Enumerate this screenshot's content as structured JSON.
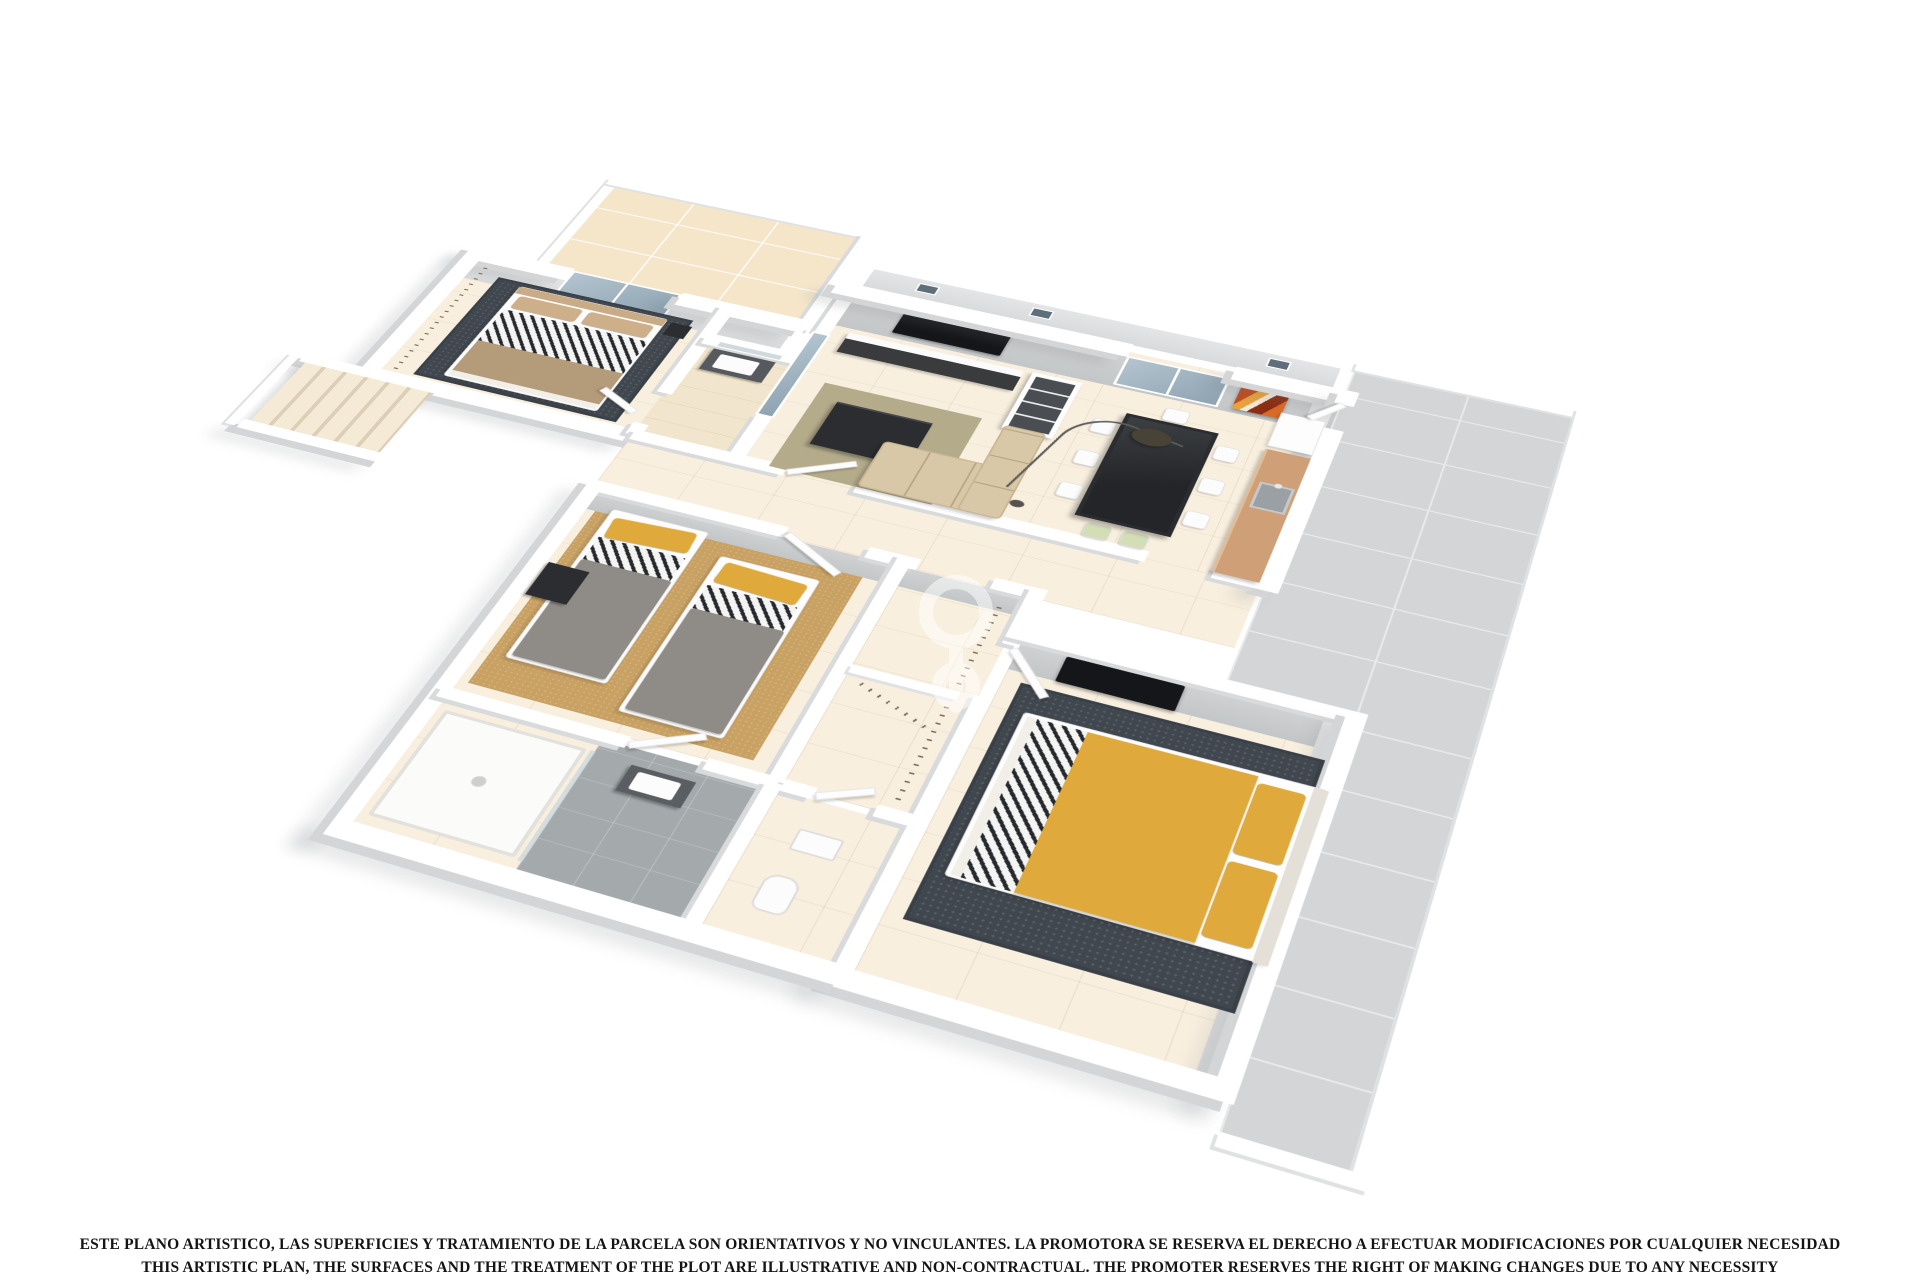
{
  "page": {
    "background_color": "#ffffff",
    "kind": "3D perspective floor plan render"
  },
  "disclaimer": {
    "line1_es": "ESTE PLANO ARTISTICO, LAS SUPERFICIES Y TRATAMIENTO DE LA PARCELA SON ORIENTATIVOS Y NO VINCULANTES. LA PROMOTORA SE RESERVA EL DERECHO A EFECTUAR MODIFICACIONES POR CUALQUIER NECESIDAD",
    "line2_en": "THIS ARTISTIC PLAN, THE SURFACES AND THE TREATMENT OF THE PLOT ARE ILLUSTRATIVE AND NON-CONTRACTUAL. THE PROMOTER RESERVES THE RIGHT OF MAKING CHANGES DUE TO ANY NECESSITY"
  },
  "watermark": {
    "description": "faint white developer monogram on floor",
    "color": "#ffffff",
    "opacity": 0.5
  },
  "colors": {
    "page_bg": "#ffffff",
    "wall_top": "#ffffff",
    "wall_face": "#c9cccd",
    "wall_shadow": "#d8dadb",
    "floor_cream": "#f8efdf",
    "terrace_beige": "#f5e6ca",
    "terrace_gray": "#d4d5d6",
    "bath_slate": "#a4a9ab",
    "carpet_tan": "#c8a163",
    "rug_dark": "#41474e",
    "rug_olive": "#b4ab8b",
    "accent_yellow": "#dfa93c",
    "bed_tan": "#c9ab85",
    "duvet_gray": "#8f8c88",
    "furniture_dark": "#2b2d30",
    "wood": "#cfa077",
    "glass": "#9fb2bf",
    "sofa_beige": "#d9c8a8",
    "painting_orange": "#c14c1e"
  },
  "scene": {
    "view": "dollhouse cutaway seen from above at an angle, white background",
    "rooms": [
      {
        "name": "terrace-top-left",
        "floor": "beige tiles",
        "features": [
          "french-doors from bedroom-1",
          "french-doors from living-room"
        ]
      },
      {
        "name": "bedroom-1",
        "floor": "cream",
        "furniture": [
          "double-bed tan headboard + chevron duvet",
          "dark dotted rug",
          "wardrobe hanging rail",
          "nightstand"
        ]
      },
      {
        "name": "exterior-stairs",
        "features": [
          "steps descending",
          "white railing"
        ]
      },
      {
        "name": "bathroom-1",
        "furniture": [
          "vanity sink",
          "mirror"
        ]
      },
      {
        "name": "living-room",
        "furniture": [
          "wall tv",
          "media unit",
          "bookcase",
          "corner sofa beige",
          "dark coffee table",
          "olive rug"
        ]
      },
      {
        "name": "dining-room",
        "furniture": [
          "dark glass dining table",
          "6 white chairs",
          "2 green chairs",
          "arc floor lamp",
          "window",
          "orange abstract painting"
        ]
      },
      {
        "name": "kitchen-strip",
        "furniture": [
          "fridge",
          "wood counter with sink",
          "door to terrace"
        ]
      },
      {
        "name": "terrace-right",
        "floor": "large gray tiles"
      },
      {
        "name": "hallway",
        "features": [
          "open doors"
        ]
      },
      {
        "name": "bedroom-2-twin",
        "furniture": [
          "two single beds gray duvets yellow pillows chevron sheets",
          "tan carpet",
          "black desk"
        ]
      },
      {
        "name": "dressing-corridor",
        "furniture": [
          "built-in wardrobes with hanging rails"
        ]
      },
      {
        "name": "bathroom-2",
        "furniture": [
          "shower tray",
          "glass screen",
          "dark vanity sink",
          "slate floor"
        ]
      },
      {
        "name": "wc",
        "furniture": [
          "sink",
          "toilet"
        ]
      },
      {
        "name": "master-bedroom",
        "furniture": [
          "double bed yellow spread chevron fold",
          "yellow pillows",
          "dark dotted rug",
          "wall tv"
        ]
      }
    ],
    "architecture": [
      "stepped parapet with small clerestory windows on back wall",
      "white wall tops",
      "gray interior wall faces"
    ]
  }
}
